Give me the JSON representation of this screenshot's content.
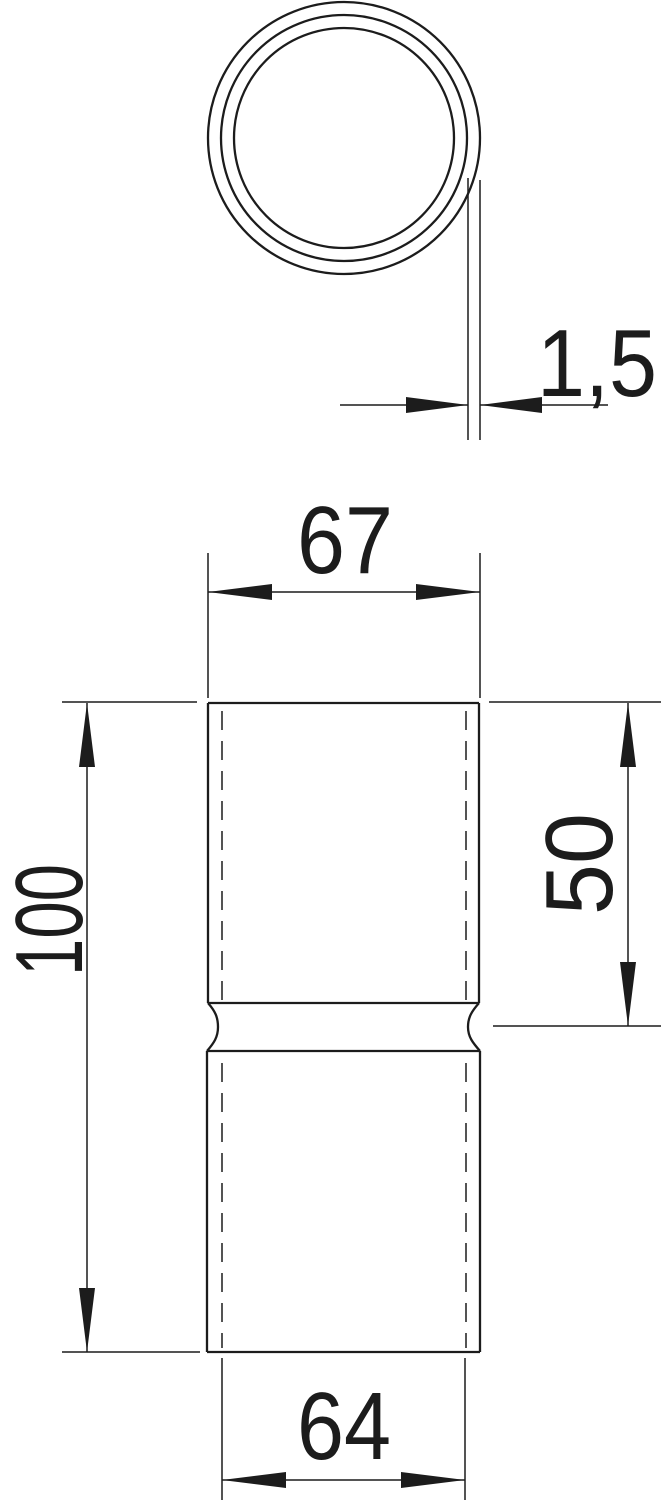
{
  "drawing": {
    "background_color": "#ffffff",
    "line_color": "#1c1c1c",
    "labels": {
      "wall_thickness": "1,5",
      "outer_width": "67",
      "overall_height": "100",
      "upper_section_height": "50",
      "inner_width": "64"
    }
  }
}
